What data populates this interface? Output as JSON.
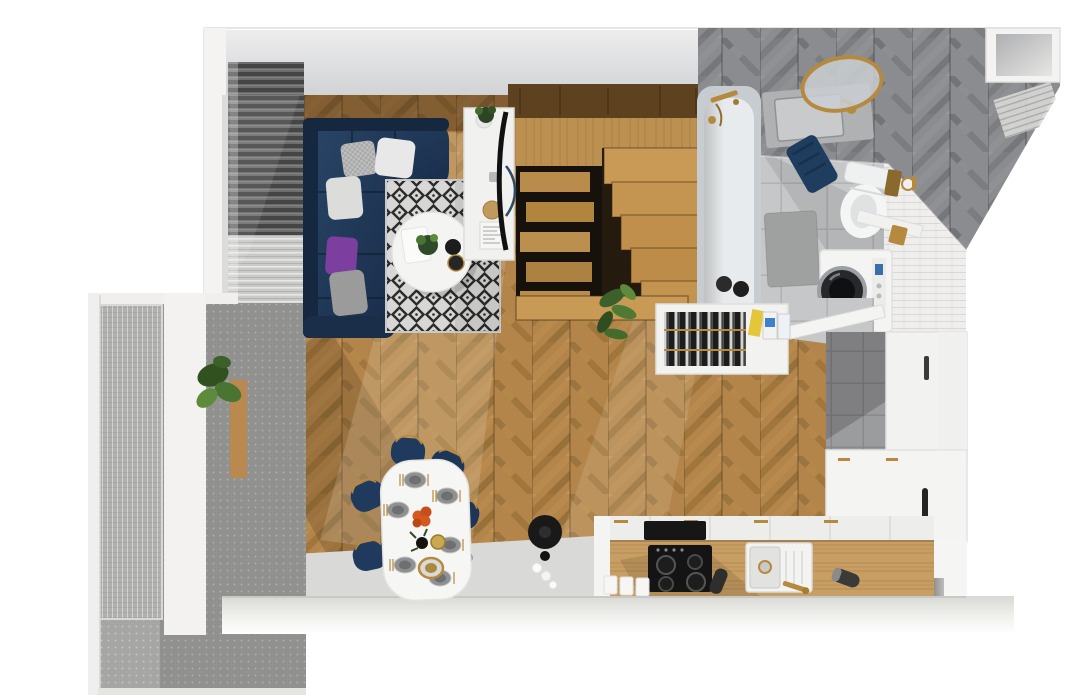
{
  "scene": {
    "title": "Apartment floor plan — 3D top-down render",
    "type": "architectural-visualization",
    "view": "top-down"
  },
  "rooms": {
    "living_room": "Living room",
    "dining_area": "Dining area",
    "kitchen": "Kitchen",
    "bathroom": "Bathroom",
    "balcony": "Balcony",
    "staircase": "Staircase",
    "hallway": "Hallway"
  },
  "furniture": {
    "living_room": [
      "corner sofa",
      "throw pillows",
      "geometric area rug",
      "round coffee table",
      "tv sideboard",
      "television",
      "window blinds",
      "potted plant"
    ],
    "dining_area": [
      "oval dining table",
      "six upholstered chairs",
      "table settings",
      "orange napkin flower"
    ],
    "kitchen": [
      "base cabinets",
      "wooden countertop",
      "cooktop",
      "sink",
      "tall cabinet column",
      "open dish drawer",
      "detergent bottles",
      "canisters",
      "stool with decor"
    ],
    "bathroom": [
      "bathtub",
      "washbasin",
      "round brass mirror",
      "toilet",
      "washing machine",
      "navy towel",
      "bath mat",
      "towel radiator",
      "wall niche"
    ],
    "staircase": [
      "wooden treads",
      "under-stair shelving",
      "fern plant",
      "upper platform"
    ],
    "balcony": [
      "glass panel door",
      "perforated metal floor",
      "potted plant",
      "wood threshold"
    ]
  },
  "palette": {
    "wall_white": "#f2f1ef",
    "wall_face_gray": "#cdced0",
    "wood_floor": "#b3854a",
    "wood_floor_dark": "#8f6a38",
    "stair_wood": "#c89a55",
    "platform_wood": "#5e411e",
    "sofa_navy": "#1f3a5c",
    "pillow_purple": "#7c3f9f",
    "pillow_white": "#e8e8e8",
    "rug_light": "#d7d7d5",
    "rug_dark": "#2c2c2c",
    "bathroom_floor_tile": "#c6c7c8",
    "chevron_wall_gray": "#8b8c8f",
    "white_tile": "#efeeec",
    "brass": "#b68a3e",
    "appliance_white": "#f4f4f3",
    "washer_door": "#26282b",
    "counter_wood": "#c79e63",
    "cooktop_black": "#141414",
    "chair_navy": "#203a5d",
    "accent_orange": "#d4581f",
    "towel_navy": "#1f3d5f",
    "plant_green": "#4a7431",
    "balcony_floor": "#a6a6a4",
    "gray_floor": "#d9d9d7"
  }
}
